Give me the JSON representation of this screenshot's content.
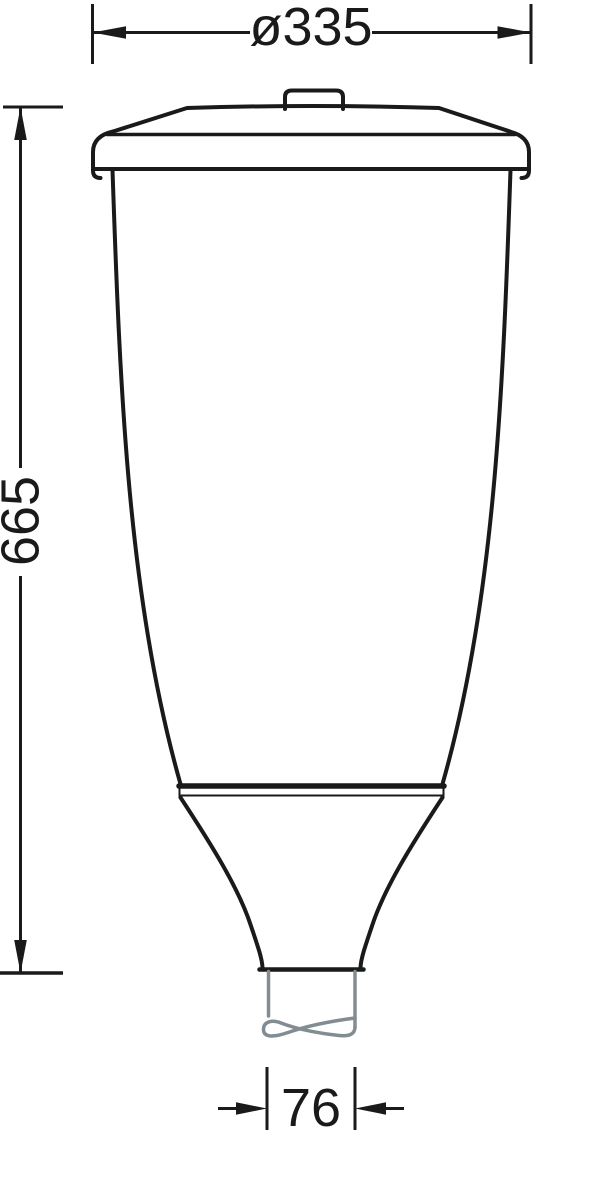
{
  "drawing": {
    "kind": "technical-dimension-diagram",
    "subject": "luminaire-profile-outline",
    "dimension_labels": {
      "top_diameter": "ø335",
      "left_height": "665",
      "bottom_spigot": "76"
    },
    "dimension_values": {
      "top_diameter": 335,
      "left_height": 665,
      "bottom_spigot": 76
    },
    "colors": {
      "outline": "#1a1a1a",
      "spigot_gray": "#828c93",
      "background": "#ffffff"
    }
  }
}
